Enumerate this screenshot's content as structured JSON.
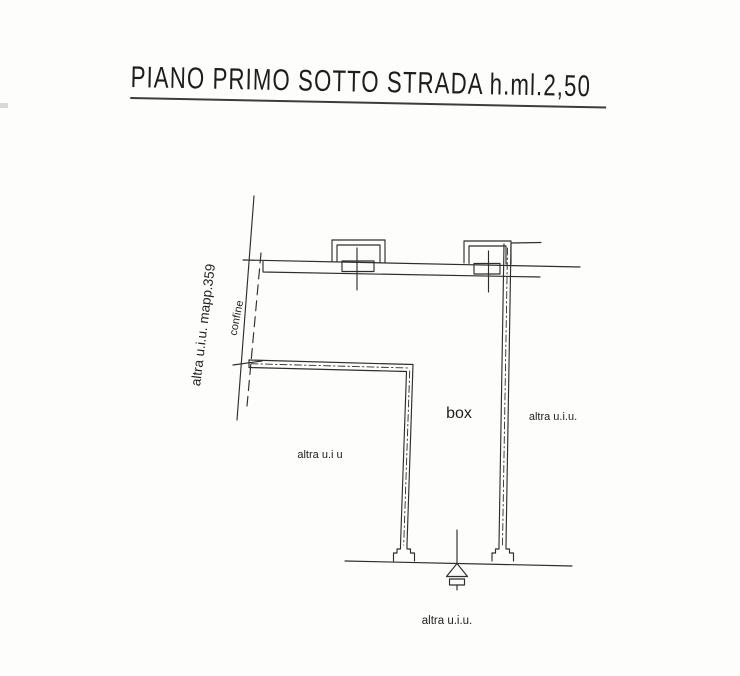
{
  "title": {
    "text": "PIANO PRIMO SOTTO STRADA h.ml.2,50"
  },
  "plan": {
    "room_label": "box",
    "labels": {
      "left_parcel": "altra u.i.u. mapp.359",
      "boundary": "confine",
      "left_unit": "altra u.i u",
      "right_unit": "altra u.i.u.",
      "bottom_unit": "altra u.i.u."
    }
  },
  "colors": {
    "ink": "#2e2e2e",
    "paper": "#fdfdfc"
  }
}
